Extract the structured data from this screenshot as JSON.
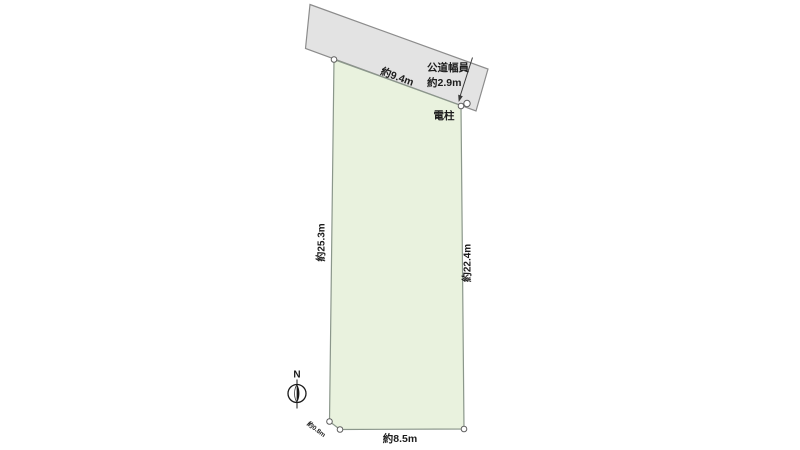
{
  "colors": {
    "background": "#ffffff",
    "road_fill": "#e3e3e3",
    "road_stroke": "#8c8c8c",
    "parcel_fill": "#e9f2de",
    "parcel_stroke": "#8b978b",
    "dimension_line": "#3a3a3a",
    "text": "#1c1c1c",
    "vertex_fill": "#ffffff",
    "vertex_stroke": "#5f5f5f",
    "compass_ink": "#1a1a1a"
  },
  "road": {
    "width_label_title": "公道幅員",
    "width_label_value": "約2.9m"
  },
  "parcel": {
    "top_edge_label": "約9.4m",
    "left_edge_label": "約25.3m",
    "right_edge_label": "約22.4m",
    "bottom_edge_label": "約8.5m",
    "corner_cut_label": "約0.8m"
  },
  "pole": {
    "label": "電柱"
  },
  "compass": {
    "north_label": "N"
  }
}
